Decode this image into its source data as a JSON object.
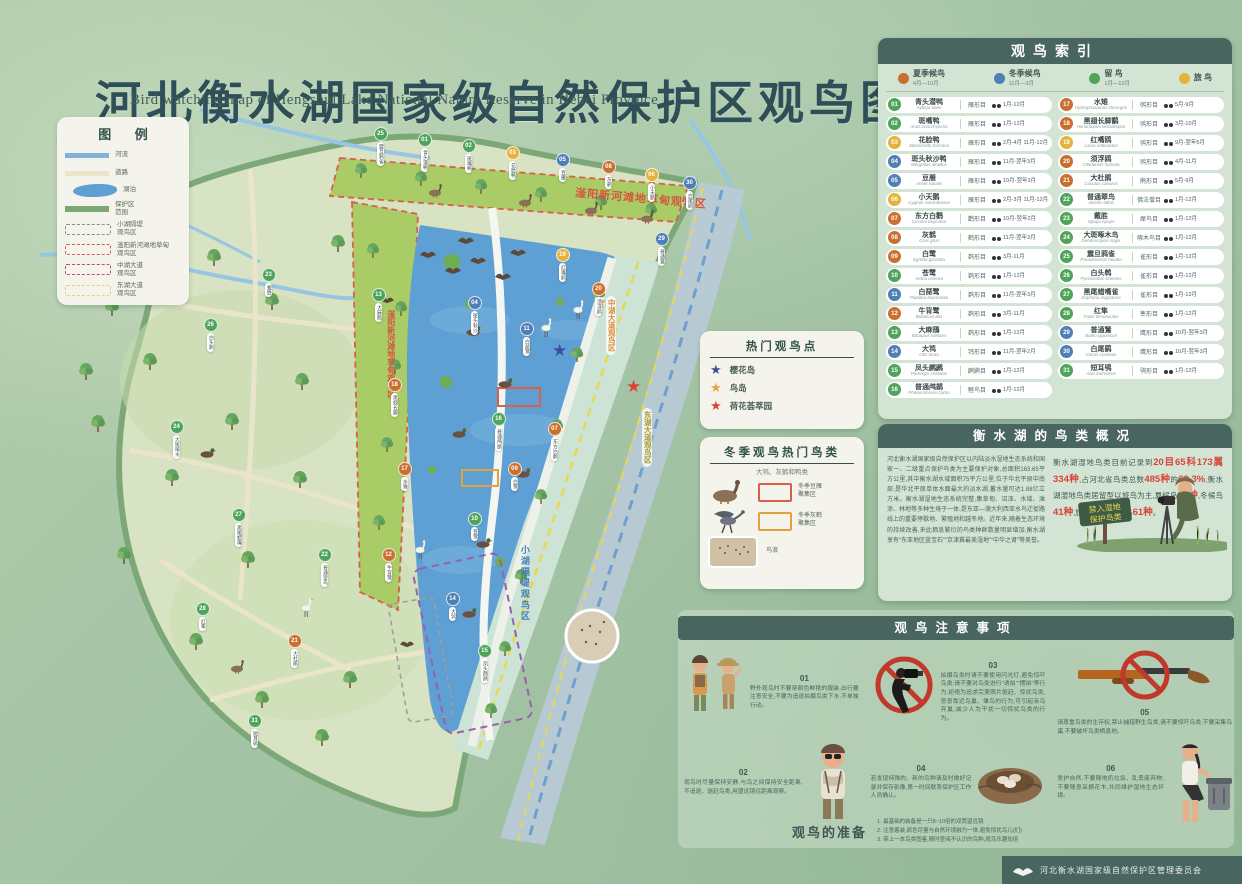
{
  "title": {
    "zh": "河北衡水湖国家级自然保护区观鸟图",
    "en": "Bird watching map of Hengshui Lake National Nature Reserve in Hebei Province"
  },
  "legend": {
    "title": "图 例",
    "items": [
      {
        "swatch": "river",
        "lines": [
          "河流"
        ]
      },
      {
        "swatch": "road",
        "lines": [
          "道路"
        ]
      },
      {
        "swatch": "lake",
        "lines": [
          "湖泊"
        ]
      },
      {
        "swatch": "bound",
        "lines": [
          "保护区",
          "范围"
        ]
      },
      {
        "swatch": "dash gray",
        "lines": [
          "小湖隔堤",
          "观鸟区"
        ]
      },
      {
        "swatch": "dash red",
        "lines": [
          "滏阳新河滩地草甸",
          "观鸟区"
        ]
      },
      {
        "swatch": "dash purple",
        "lines": [
          "中湖大道",
          "观鸟区"
        ]
      },
      {
        "swatch": "dash yellow",
        "lines": [
          "东湖大道",
          "观鸟区"
        ]
      }
    ]
  },
  "map": {
    "labels": {
      "meadow": "滏阳新河滩地草甸观鸟区",
      "strip": "滏阳新河滩地草甸观鸟区",
      "xiaohu": "小湖隔堤观鸟区",
      "zhonghu": "中湖大道观鸟区",
      "donghu": "东湖大道观鸟区",
      "photo": "鸟浪"
    },
    "markers": [
      {
        "n": "25",
        "x": 374,
        "y": 127
      },
      {
        "n": "01",
        "x": 418,
        "y": 133
      },
      {
        "n": "02",
        "x": 462,
        "y": 139
      },
      {
        "n": "03",
        "x": 506,
        "y": 146
      },
      {
        "n": "05",
        "x": 556,
        "y": 153
      },
      {
        "n": "08",
        "x": 602,
        "y": 160
      },
      {
        "n": "06",
        "x": 645,
        "y": 168
      },
      {
        "n": "30",
        "x": 683,
        "y": 176
      },
      {
        "n": "23",
        "x": 262,
        "y": 268
      },
      {
        "n": "26",
        "x": 204,
        "y": 318
      },
      {
        "n": "24",
        "x": 170,
        "y": 420
      },
      {
        "n": "27",
        "x": 232,
        "y": 508
      },
      {
        "n": "22",
        "x": 318,
        "y": 548
      },
      {
        "n": "28",
        "x": 196,
        "y": 602
      },
      {
        "n": "21",
        "x": 288,
        "y": 634
      },
      {
        "n": "31",
        "x": 248,
        "y": 714
      },
      {
        "n": "13",
        "x": 372,
        "y": 288
      },
      {
        "n": "18",
        "x": 388,
        "y": 378
      },
      {
        "n": "17",
        "x": 398,
        "y": 462
      },
      {
        "n": "12",
        "x": 382,
        "y": 548
      },
      {
        "n": "19",
        "x": 556,
        "y": 248
      },
      {
        "n": "20",
        "x": 592,
        "y": 282
      },
      {
        "n": "04",
        "x": 468,
        "y": 296
      },
      {
        "n": "11",
        "x": 520,
        "y": 322
      },
      {
        "n": "16",
        "x": 492,
        "y": 412
      },
      {
        "n": "07",
        "x": 548,
        "y": 422
      },
      {
        "n": "09",
        "x": 508,
        "y": 462
      },
      {
        "n": "10",
        "x": 468,
        "y": 512
      },
      {
        "n": "14",
        "x": 446,
        "y": 592
      },
      {
        "n": "15",
        "x": 478,
        "y": 644
      },
      {
        "n": "29",
        "x": 655,
        "y": 232
      }
    ]
  },
  "index": {
    "title": "观鸟索引",
    "type_colors": {
      "s": "#c96f2f",
      "w": "#4f7fb5",
      "r": "#4fa45c",
      "p": "#e4b33c"
    },
    "types": [
      {
        "key": "s",
        "label": "夏季候鸟",
        "months": "4月—10月"
      },
      {
        "key": "w",
        "label": "冬季候鸟",
        "months": "11月—3月"
      },
      {
        "key": "r",
        "label": "留  鸟",
        "months": "1月—12月"
      },
      {
        "key": "p",
        "label": "旅  鸟",
        "months": ""
      }
    ],
    "birds": [
      {
        "n": "01",
        "name": "青头潜鸭",
        "latin": "Aythya baeri",
        "order": "雁形目",
        "months": "1月-12月",
        "type": "r"
      },
      {
        "n": "02",
        "name": "斑嘴鸭",
        "latin": "Anas zonorhyncha",
        "order": "雁形目",
        "months": "1月-12月",
        "type": "r"
      },
      {
        "n": "03",
        "name": "花脸鸭",
        "latin": "Sibirionetta formosa",
        "order": "雁形目",
        "months": "2月-4月 11月-12月",
        "type": "p"
      },
      {
        "n": "04",
        "name": "斑头秋沙鸭",
        "latin": "Mergellus albellus",
        "order": "雁形目",
        "months": "11月-翌年3月",
        "type": "w"
      },
      {
        "n": "05",
        "name": "豆雁",
        "latin": "Anser fabalis",
        "order": "雁形目",
        "months": "10月-翌年3月",
        "type": "w"
      },
      {
        "n": "06",
        "name": "小天鹅",
        "latin": "Cygnus columbianus",
        "order": "雁形目",
        "months": "2月-3月 11月-12月",
        "type": "p"
      },
      {
        "n": "07",
        "name": "东方白鹳",
        "latin": "Ciconia boyciana",
        "order": "鹳形目",
        "months": "10月-翌年2月",
        "type": "s"
      },
      {
        "n": "08",
        "name": "灰鹤",
        "latin": "Grus grus",
        "order": "鹤形目",
        "months": "11月-翌年3月",
        "type": "s"
      },
      {
        "n": "09",
        "name": "白鹭",
        "latin": "Egretta garzetta",
        "order": "鹈形目",
        "months": "3月-11月",
        "type": "s"
      },
      {
        "n": "10",
        "name": "苍鹭",
        "latin": "Ardea cinerea",
        "order": "鹈形目",
        "months": "1月-12月",
        "type": "r"
      },
      {
        "n": "11",
        "name": "白琵鹭",
        "latin": "Platalea leucorodia",
        "order": "鹈形目",
        "months": "11月-翌年3月",
        "type": "w"
      },
      {
        "n": "12",
        "name": "牛背鹭",
        "latin": "Bubulcus ibis",
        "order": "鹈形目",
        "months": "3月-11月",
        "type": "s"
      },
      {
        "n": "13",
        "name": "大麻鳽",
        "latin": "Botaurus stellaris",
        "order": "鹈形目",
        "months": "1月-12月",
        "type": "r"
      },
      {
        "n": "14",
        "name": "大鸨",
        "latin": "Otis tarda",
        "order": "鸨形目",
        "months": "11月-翌年2月",
        "type": "w"
      },
      {
        "n": "15",
        "name": "凤头䴙䴘",
        "latin": "Podiceps cristatus",
        "order": "䴙䴘目",
        "months": "1月-12月",
        "type": "r"
      },
      {
        "n": "16",
        "name": "普通鸬鹚",
        "latin": "Phalacrocorax carbo",
        "order": "鲣鸟目",
        "months": "1月-12月",
        "type": "r"
      },
      {
        "n": "17",
        "name": "水雉",
        "latin": "Hydrophasianus chirurgus",
        "order": "鸻形目",
        "months": "5月-9月",
        "type": "s"
      },
      {
        "n": "18",
        "name": "黑翅长脚鹬",
        "latin": "Himantopus himantopus",
        "order": "鸻形目",
        "months": "3月-10月",
        "type": "s"
      },
      {
        "n": "19",
        "name": "红嘴鸥",
        "latin": "Larus ridibundus",
        "order": "鸻形目",
        "months": "9月-翌年5月",
        "type": "p"
      },
      {
        "n": "20",
        "name": "须浮鸥",
        "latin": "Chlidonias hybrida",
        "order": "鸻形目",
        "months": "4月-11月",
        "type": "s"
      },
      {
        "n": "21",
        "name": "大杜鹃",
        "latin": "Cuculus canorus",
        "order": "鹃形目",
        "months": "5月-9月",
        "type": "s"
      },
      {
        "n": "22",
        "name": "普通翠鸟",
        "latin": "Alcedo atthis",
        "order": "佛法僧目",
        "months": "1月-12月",
        "type": "r"
      },
      {
        "n": "23",
        "name": "戴胜",
        "latin": "Upupa epops",
        "order": "犀鸟目",
        "months": "1月-12月",
        "type": "r"
      },
      {
        "n": "24",
        "name": "大斑啄木鸟",
        "latin": "Dendrocopos major",
        "order": "啄木鸟目",
        "months": "1月-12月",
        "type": "r"
      },
      {
        "n": "25",
        "name": "震旦鸦雀",
        "latin": "Paradoxornis heudei",
        "order": "雀形目",
        "months": "1月-12月",
        "type": "r"
      },
      {
        "n": "26",
        "name": "白头鹎",
        "latin": "Pycnonotus sinensis",
        "order": "雀形目",
        "months": "1月-12月",
        "type": "r"
      },
      {
        "n": "27",
        "name": "黑尾蜡嘴雀",
        "latin": "Eophona migratoria",
        "order": "雀形目",
        "months": "1月-12月",
        "type": "r"
      },
      {
        "n": "28",
        "name": "红隼",
        "latin": "Falco tinnunculus",
        "order": "隼形目",
        "months": "1月-12月",
        "type": "r"
      },
      {
        "n": "29",
        "name": "普通鵟",
        "latin": "Buteo japonicus",
        "order": "鹰形目",
        "months": "10月-翌年3月",
        "type": "w"
      },
      {
        "n": "30",
        "name": "白尾鹞",
        "latin": "Circus cyaneus",
        "order": "鹰形目",
        "months": "10月-翌年3月",
        "type": "w"
      },
      {
        "n": "31",
        "name": "短耳鸮",
        "latin": "Asio flammeus",
        "order": "鸮形目",
        "months": "1月-12月",
        "type": "r"
      }
    ]
  },
  "hotspots": {
    "title": "热门观鸟点",
    "items": [
      {
        "star": "#3b4fa0",
        "label": "樱花岛"
      },
      {
        "star": "#e8a33d",
        "label": "鸟岛"
      },
      {
        "star": "#d84438",
        "label": "荷花荟萃园"
      }
    ]
  },
  "winter": {
    "title": "冬季观鸟热门鸟类",
    "subtitle": "大鸨、灰鹤和鸭类",
    "items": [
      {
        "label1": "冬季豆雁",
        "label2": "聚集区",
        "box": "#d8604a"
      },
      {
        "label1": "冬季灰鹤",
        "label2": "聚集区",
        "box": "#e0a23e"
      },
      {
        "label1": "鸟浪",
        "label2": "",
        "box": ""
      }
    ]
  },
  "overview": {
    "title": "衡水湖的鸟类概况",
    "paragraph": "河北衡水湖国家级自然保护区以内陆淡水湿地生态系统和国家一、二级重点保护鸟类为主要保护对象,总面积163.65平方公里,其中衡水湖水域面积75平方公里,位于华北平原中南部,是华北平原单体水面最大的淡水湖,蓄水量可达1.88亿立方米。衡水湖湿地生态系统完整,集草甸、沼泽、水域、滩涂、林地等多种生境于一体,是东亚—澳大利西亚水鸟迁徙路线上的重要停歇地、繁殖地和越冬地。近年来,随着生态环境的持续改善,来此栖息繁衍的鸟类种群数量明显增加,衡水湖享有“东亚地区蓝宝石”“京津冀最美湿地”“中华之肾”等美誉。",
    "stats_segments": [
      {
        "t": "衡水湖湿地鸟类目前记录到",
        "h": false
      },
      {
        "t": "20目65科",
        "h": true
      },
      {
        "t": "173属334种",
        "h": true
      },
      {
        "t": ",占河北省鸟类总数",
        "h": false
      },
      {
        "t": "485种",
        "h": true
      },
      {
        "t": "的",
        "h": false
      },
      {
        "t": "68.3%",
        "h": true
      },
      {
        "t": ",衡水湖湿地鸟类居留型以旅鸟为主,夏候鸟",
        "h": false
      },
      {
        "t": "87种",
        "h": true
      },
      {
        "t": ",冬候鸟",
        "h": false
      },
      {
        "t": "41种",
        "h": true
      },
      {
        "t": ",旅鸟",
        "h": false
      },
      {
        "t": "164种",
        "h": true
      },
      {
        "t": ",留鸟",
        "h": false
      },
      {
        "t": "61种",
        "h": true
      },
      {
        "t": "。",
        "h": false
      }
    ],
    "sign_line1": "禁入湿地",
    "sign_line2": "保护鸟类"
  },
  "notices": {
    "title": "观鸟注意事项",
    "items": [
      {
        "num": "01",
        "text": "野外观鸟时不要穿颜色鲜艳的服装,出行要注意安全,不要为追逐拍摄鸟类下水,不单独行动。"
      },
      {
        "num": "02",
        "text": "观鸟时尽量保持安静,与鸟之间保持安全距离,不追逐、驱赶鸟类,用望远镜远距离观察。"
      },
      {
        "num": "03",
        "text": "拍摄鸟类时请不要使用闪光灯,避免惊吓鸟类;请不要对鸟类进行“诱拍”“摆拍”等行为;拒绝为追求完美照片驱赶、惊扰鸟类,恶意靠近鸟巢、雏鸟的行为,可引起亲鸟弃巢,减少人为干扰一切惊扰鸟类的行为。"
      },
      {
        "num": "04",
        "text": "若发现特殊的、新的鸟种请及时做好记录并保存影像,第一时间联系保护区工作人员确认。"
      },
      {
        "num": "05",
        "text": "请尊重鸟类的生存权,禁止捕猎野生鸟类,请不要惊吓鸟类,不要采集鸟蛋,不要破坏鸟类栖息地。"
      },
      {
        "num": "06",
        "text": "爱护自然,不要随地扔垃圾、乱丢废弃物;不要随意采摘花木,共同维护湿地生态环境。"
      }
    ]
  },
  "prep": {
    "title": "观鸟的准备",
    "lines": [
      "1. 最基础的装备是一只8~10倍的双筒望远镜",
      "2. 注意着装,颜色尽量与自然环境融为一体,避免惊扰鸟儿(们)",
      "3. 带上一本鸟类图鉴,随时查阅不认识的鸟种,观鸟乐趣加倍"
    ]
  },
  "footer": {
    "org": "河北衡水湖国家级自然保护区管理委员会"
  }
}
